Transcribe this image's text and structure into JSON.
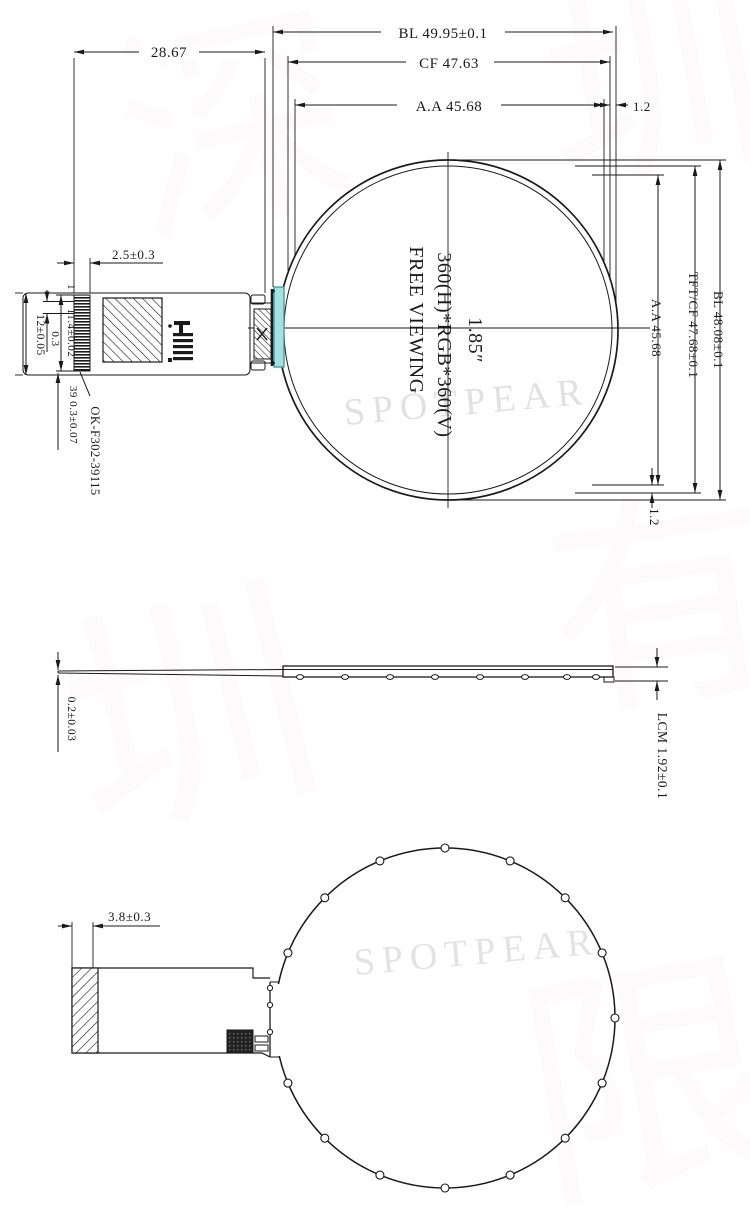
{
  "top_view": {
    "dim_bl_width": "BL 49.95±0.1",
    "dim_cf_width": "CF 47.63",
    "dim_aa_width": "A.A 45.68",
    "dim_edge_top_right": "1.2",
    "dim_fpc_to_edge": "28.67",
    "dim_finger_length": "2.5±0.3",
    "dim_fpc_width": "12±0.05",
    "dim_pin_offset": "0.3",
    "dim_finger_height": "11.4±0.02",
    "pin_one_label": "1",
    "dim_pin_count_pitch": "39 0.3±0.07",
    "connector_part_no": "OK-F302-39115",
    "dim_aa_height": "A.A 45.68",
    "dim_tftcf_height": "TFT/CF 47.68±0.1",
    "dim_bl_height": "BL 48.08±0.1",
    "dim_edge_bottom_right": "1.2",
    "screen_resolution": "360(H)*RGB*360(V)",
    "screen_viewing": "FREE VIEWING",
    "screen_size": "1.85″"
  },
  "side_view": {
    "dim_fpc_thickness": "0.2±0.03",
    "dim_lcm_thickness": "LCM 1.92±0.1"
  },
  "back_view": {
    "dim_stiffener_width": "3.8±0.3"
  },
  "watermark": {
    "brand_top": "SPOTPEAR",
    "brand_bottom": "SPOTPEAR",
    "cn_char_1": "深",
    "cn_char_2": "圳",
    "cn_char_3": "有",
    "cn_char_4": "限"
  },
  "colors": {
    "line": "#1a1a1a",
    "teal_fill": "#a6e0e0",
    "teal_stroke": "#2f9e9e",
    "watermark_gray": "#c9c9c9",
    "watermark_pink": "#cfb3b3"
  }
}
